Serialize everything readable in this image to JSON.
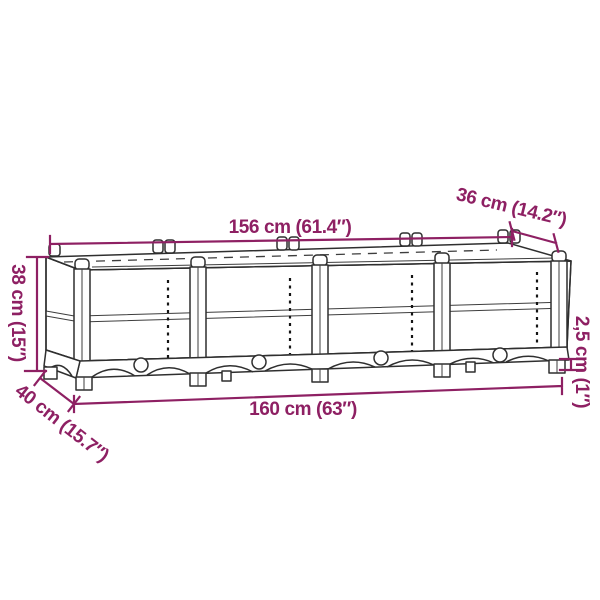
{
  "diagram": {
    "type": "product-dimension-line-drawing",
    "subject": "raised garden bed planter with four woven rattan-look panels, corner posts, arched base skirt and small feet",
    "colors": {
      "dimension": "#8e2063",
      "line": "#2f2f2f",
      "background": "#ffffff"
    },
    "labels": {
      "top_length": "156 cm (61.4″)",
      "top_depth": "36 cm (14.2″)",
      "side_height": "38 cm (15″)",
      "bottom_depth": "40 cm (15.7″)",
      "bottom_length": "160 cm (63″)",
      "foot_height": "2,5 cm (1″)"
    }
  }
}
